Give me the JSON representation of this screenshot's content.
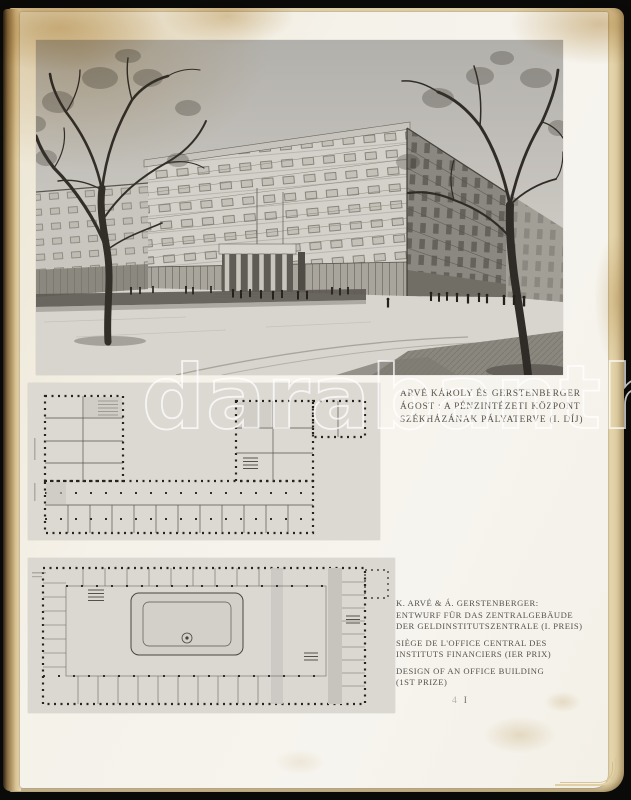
{
  "scan": {
    "watermark_text": "darabanth",
    "page_marker": {
      "left": "4",
      "right": "I"
    }
  },
  "captions": {
    "hungarian": {
      "line1": "ARVÉ KÁROLY ÉS GERSTENBERGER",
      "line2": "ÁGOST : A PÉNZINTÉZETI KÖZPONT",
      "line3": "SZÉKHÁZÁNAK PÁLYATERVE (I. DÍJ)"
    },
    "german": {
      "line1": "K. ARVÉ & Á. GERSTENBERGER:",
      "line2": "ENTWURF FÜR DAS ZENTRALGEBÄUDE",
      "line3": "DER GELDINSTITUTSZENTRALE (I. PREIS)"
    },
    "french": {
      "line1": "SIÈGE DE L'OFFICE CENTRAL DES",
      "line2": "INSTITUTS FINANCIERS (IER PRIX)"
    },
    "english": {
      "line1": "DESIGN OF AN OFFICE BUILDING",
      "line2": "(1ST PRIZE)"
    }
  },
  "colors": {
    "background": "#0a0a09",
    "paper_white": "#f4f1e9",
    "paper_aged": "#e2cfa2",
    "photo_gray": "#d2cfc8",
    "ink": "#56514b",
    "watermark": "#ffffff"
  }
}
